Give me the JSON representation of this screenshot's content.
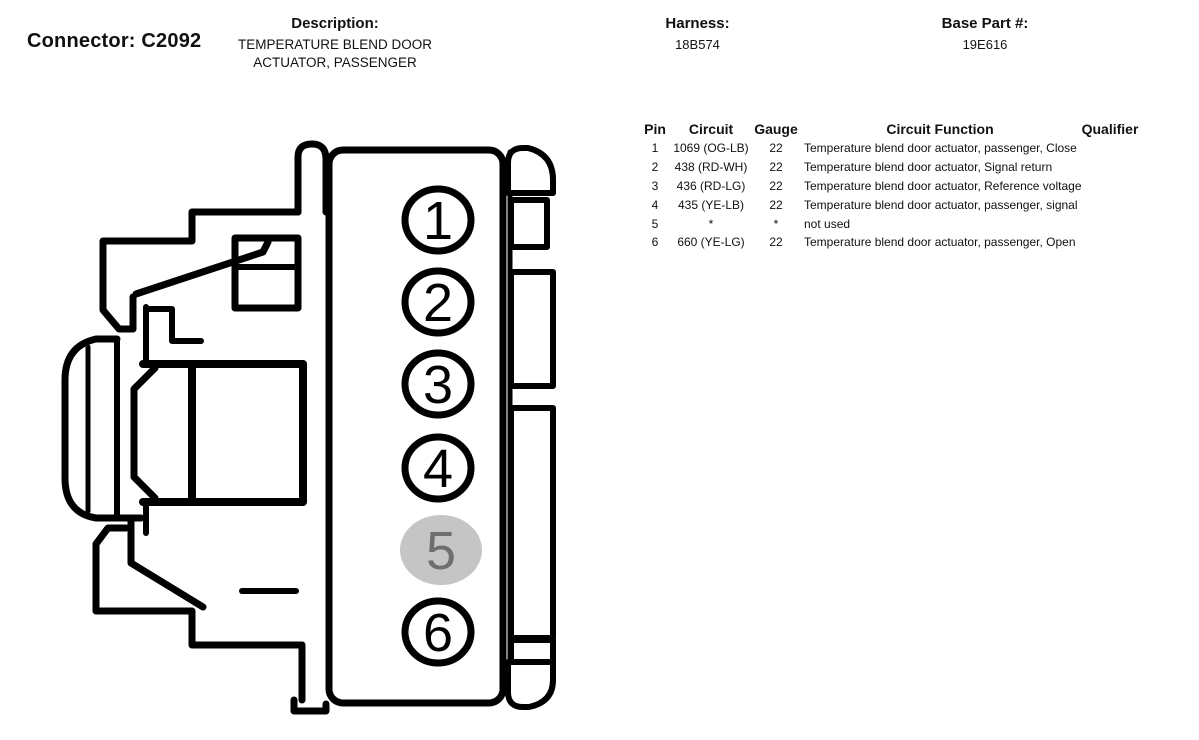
{
  "header": {
    "connector_label": "Connector: C2092",
    "description_label": "Description:",
    "description_line1": "TEMPERATURE BLEND DOOR",
    "description_line2": "ACTUATOR, PASSENGER",
    "harness_label": "Harness:",
    "harness_value": "18B574",
    "base_part_label": "Base Part #:",
    "base_part_value": "19E616"
  },
  "diagram": {
    "name": "connector-side-view-pinout",
    "line_color": "#000000",
    "highlight_color": "#c5c5c5",
    "highlight_text_color": "#6f6f6f",
    "pins": [
      {
        "number": "1",
        "highlighted": false
      },
      {
        "number": "2",
        "highlighted": false
      },
      {
        "number": "3",
        "highlighted": false
      },
      {
        "number": "4",
        "highlighted": false
      },
      {
        "number": "5",
        "highlighted": true
      },
      {
        "number": "6",
        "highlighted": false
      }
    ]
  },
  "pin_table": {
    "columns": [
      "Pin",
      "Circuit",
      "Gauge",
      "Circuit Function",
      "Qualifier"
    ],
    "rows": [
      {
        "pin": "1",
        "circuit": "1069 (OG-LB)",
        "gauge": "22",
        "function": "Temperature blend door actuator, passenger, Close",
        "qualifier": ""
      },
      {
        "pin": "2",
        "circuit": "438 (RD-WH)",
        "gauge": "22",
        "function": "Temperature blend door actuator, Signal return",
        "qualifier": ""
      },
      {
        "pin": "3",
        "circuit": "436 (RD-LG)",
        "gauge": "22",
        "function": "Temperature blend door actuator, Reference voltage",
        "qualifier": ""
      },
      {
        "pin": "4",
        "circuit": "435 (YE-LB)",
        "gauge": "22",
        "function": "Temperature blend door actuator, passenger, signal",
        "qualifier": ""
      },
      {
        "pin": "5",
        "circuit": "*",
        "gauge": "*",
        "function": "not used",
        "qualifier": ""
      },
      {
        "pin": "6",
        "circuit": "660 (YE-LG)",
        "gauge": "22",
        "function": "Temperature blend door actuator, passenger, Open",
        "qualifier": ""
      }
    ]
  }
}
